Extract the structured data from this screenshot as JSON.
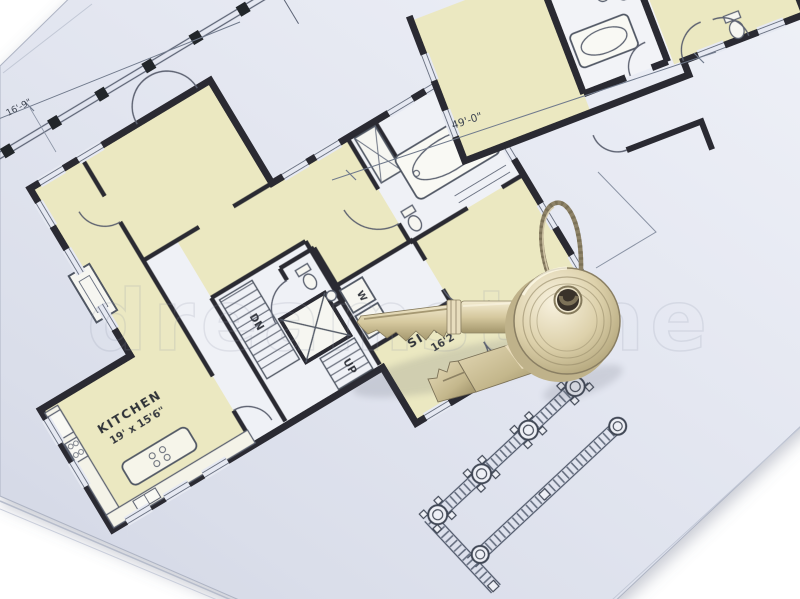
{
  "scene": {
    "background_color": "#ffffff",
    "paper_color": "#e0e4ef",
    "room_fill_color": "#ebe8c1",
    "wall_color": "#2b2c31",
    "thin_line_color": "#5b6375",
    "brass_light": "#f1e9cf",
    "brass_dark": "#9e9168",
    "watermark_text": "dreamstime"
  },
  "blueprint": {
    "main_plan": {
      "rooms": [
        {
          "name": "KITCHEN",
          "size": "19' x 15'6\""
        },
        {
          "name": "SITTING",
          "size": "16'2\""
        }
      ],
      "stairs": {
        "down": "DN",
        "up": "UP"
      },
      "laundry": {
        "washer": "W",
        "dryer": "D"
      }
    },
    "dimensions": [
      {
        "label": "49'-0\""
      },
      {
        "label": "16'-9\""
      }
    ]
  },
  "keys": {
    "count": 2,
    "ring": "twisted wire keyring"
  }
}
